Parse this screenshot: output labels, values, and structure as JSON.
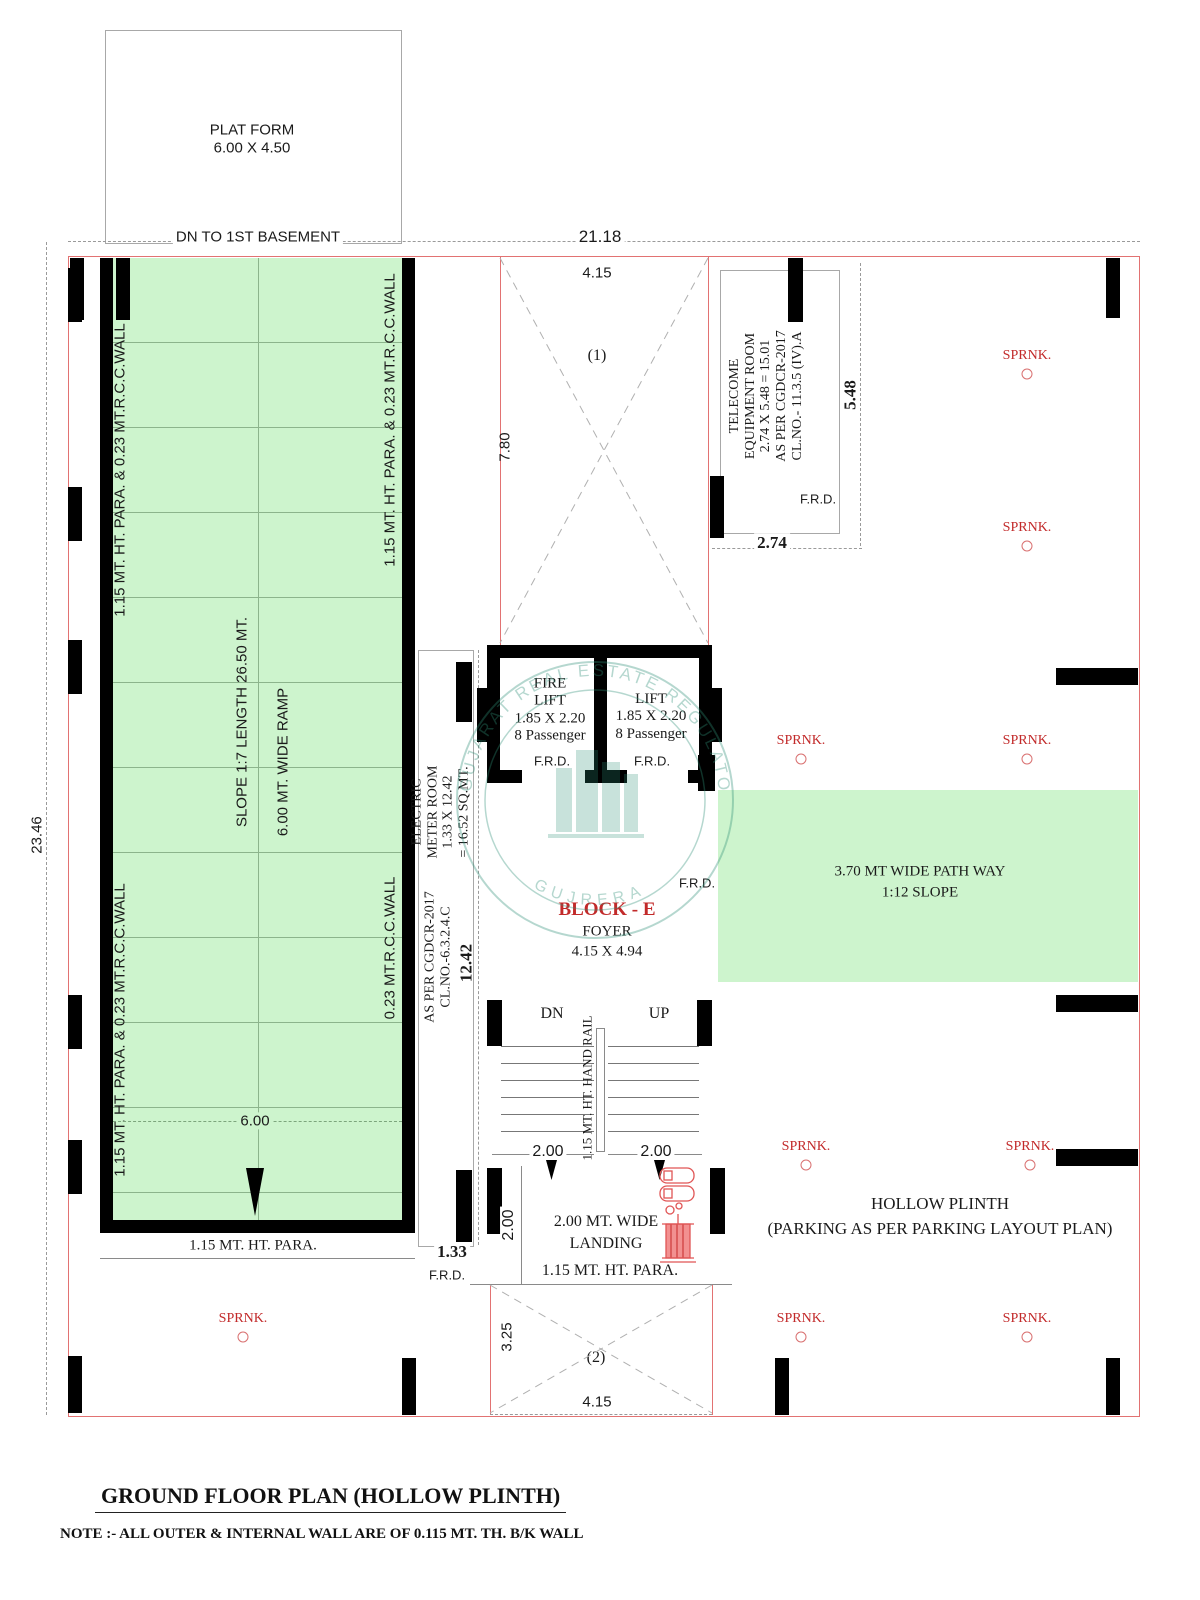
{
  "colors": {
    "wall_green": "#cdf4cd",
    "line_red": "#e27272",
    "text_red": "#c22a2a",
    "wall_black": "#000000",
    "watermark_teal": "#2e9077"
  },
  "header": {
    "platform_l1": "PLAT FORM",
    "platform_l2": "6.00 X 4.50",
    "dn_basement": "DN TO 1ST BASEMENT"
  },
  "dims": {
    "total_w": "21.18",
    "total_h": "23.46",
    "bay_top": "4.15",
    "void1_h": "7.80",
    "telecom_w": "2.74",
    "telecom_h": "5.48",
    "meter_len": "12.42",
    "meter_w": "1.33",
    "ramp_w": "6.00",
    "flight_l": "2.00",
    "flight_r": "2.00",
    "landing_d": "2.00",
    "void2_h": "3.25",
    "void2_w": "4.15"
  },
  "voids": {
    "v1": "(1)",
    "v2": "(2)"
  },
  "ramp": {
    "wall_full": "1.15 MT. HT. PARA. & 0.23 MT.R.C.C.WALL",
    "wall_rcc": "0.23 MT.R.C.C.WALL",
    "slope": "SLOPE 1:7  LENGTH  26.50 MT.",
    "width": "6.00 MT. WIDE RAMP",
    "para": "1.15 MT. HT. PARA."
  },
  "telecom": {
    "l1": "TELECOME",
    "l2": "EQUIPMENT  ROOM",
    "l3": "2.74 X 5.48 = 15.01",
    "l4": "AS PER CGDCR-2017",
    "l5": "CL.NO.- 11.3.5 (IV).A"
  },
  "meter": {
    "l1": "ELECTRIC",
    "l2": "METER ROOM",
    "l3": "1.33 X 12.42",
    "l4": "= 16.52 SQ.MT.",
    "l5": "AS PER CGDCR-2017",
    "l6": "CL.NO.-6.3.2.4.C"
  },
  "lifts": {
    "fire_l1": "FIRE",
    "fire_l2": "LIFT",
    "fire_size": "1.85 X 2.20",
    "fire_cap": "8 Passenger",
    "lift_l1": "LIFT",
    "lift_size": "1.85 X 2.20",
    "lift_cap": "8 Passenger"
  },
  "labels": {
    "frd": "F.R.D.",
    "sprnk": "SPRNK."
  },
  "block": {
    "name": "BLOCK - E",
    "room": "FOYER",
    "size": "4.15 X 4.94"
  },
  "pathway": {
    "l1": "3.70 MT WIDE  PATH WAY",
    "l2": "1:12 SLOPE"
  },
  "stairs": {
    "dn": "DN",
    "up": "UP",
    "rail": "1.15 MT. HT. HAND RAIL",
    "landing_l1": "2.00 MT. WIDE",
    "landing_l2": "LANDING",
    "para": "1.15 MT. HT. PARA."
  },
  "plinth": {
    "l1": "HOLLOW PLINTH",
    "l2": "(PARKING AS PER PARKING LAYOUT PLAN)"
  },
  "watermark": {
    "arc_top": "GUJARAT REAL ESTATE REGULATORY AUTHORITY",
    "arc_bottom": "GUJRERA"
  },
  "footer": {
    "title": "GROUND FLOOR PLAN (HOLLOW PLINTH)",
    "note": "NOTE :- ALL OUTER & INTERNAL WALL ARE OF 0.115 MT. TH. B/K WALL"
  }
}
